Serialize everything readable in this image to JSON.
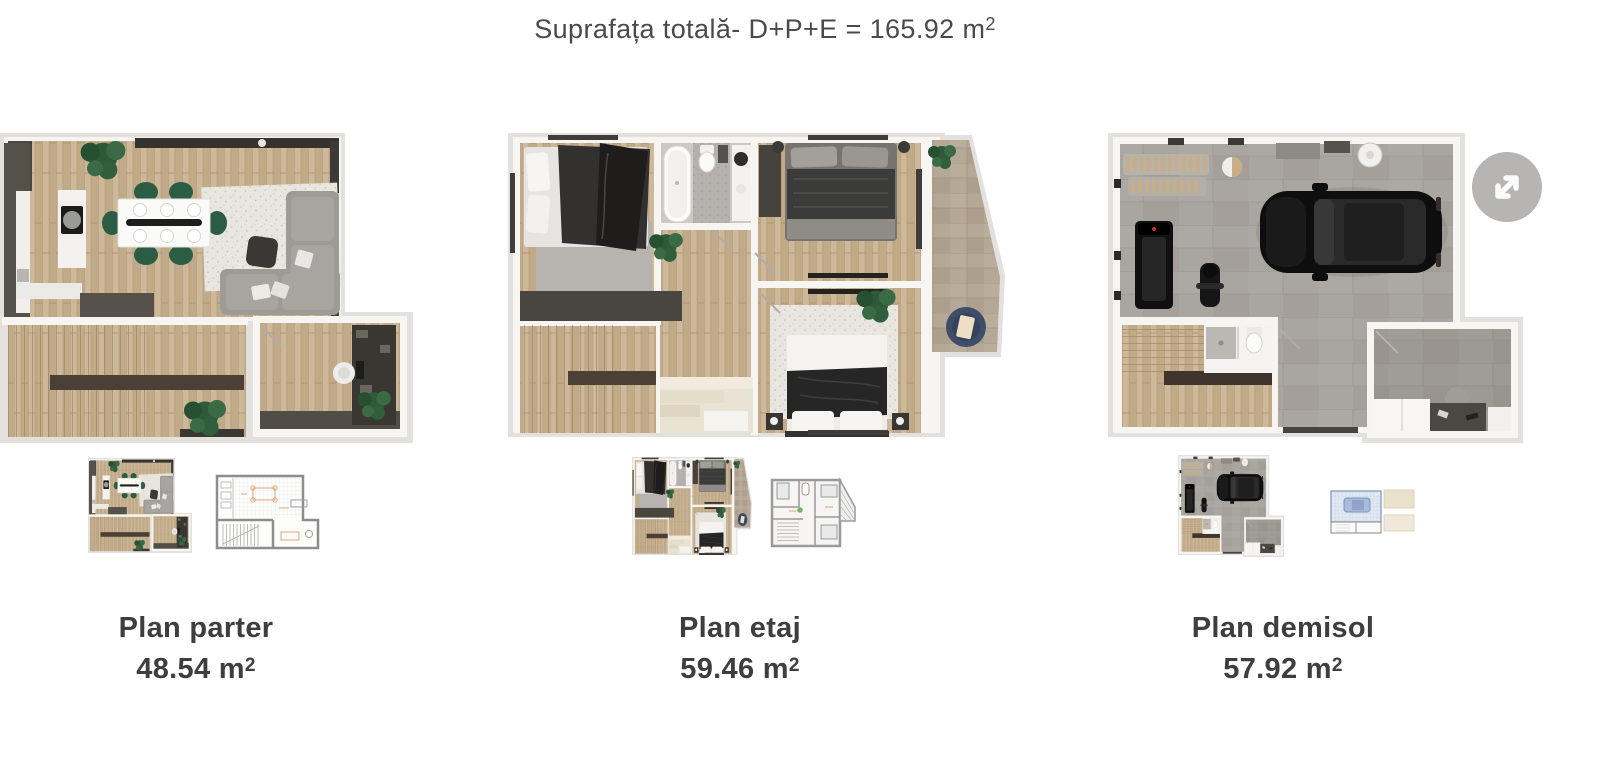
{
  "header": {
    "title_main": "Suprafața totală- D+P+E = 165.92 m",
    "title_sup": "2"
  },
  "plans": [
    {
      "name": "Plan parter",
      "area_value": "48.54 m",
      "area_sup": "2"
    },
    {
      "name": "Plan etaj",
      "area_value": "59.46 m",
      "area_sup": "2"
    },
    {
      "name": "Plan demisol",
      "area_value": "57.92 m",
      "area_sup": "2"
    }
  ],
  "controls": {
    "expand_icon_name": "expand-diagonal-arrows-icon"
  },
  "colors": {
    "page_bg": "#ffffff",
    "plan_backdrop": "#e3e1de",
    "wall_white": "#f6f5f2",
    "wood_floor": "#c8b293",
    "concrete_floor": "#a9a5a0",
    "terrace_stone": "#b5a896",
    "accent_green_chairs": "#2b5d45",
    "pouf_blue": "#3e4d68",
    "text": "#424242",
    "expand_button_bg": "#b6b5b4"
  }
}
